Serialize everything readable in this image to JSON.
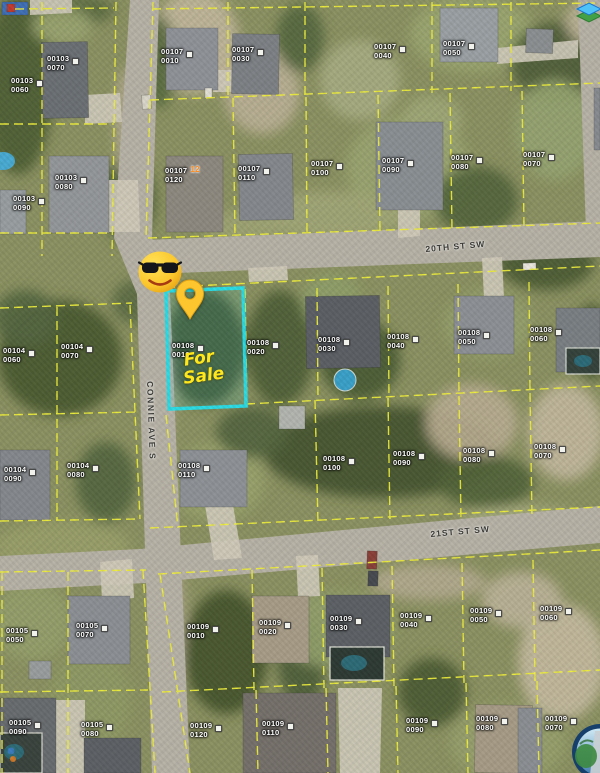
{
  "map": {
    "streets": [
      {
        "name": "20TH ST SW",
        "orientation": "horizontal"
      },
      {
        "name": "21ST ST SW",
        "orientation": "horizontal"
      },
      {
        "name": "CONNIE AVE S",
        "orientation": "vertical"
      }
    ],
    "listing": {
      "line1": "For",
      "line2": "Sale",
      "parcel": "00108 0010",
      "highlight_color": "#2bdce5",
      "text_color": "#ffe71c"
    },
    "icons": {
      "marker": "location-pin-icon",
      "emoji": "sunglasses-face-emoji",
      "top_right": "map-layers-icon",
      "bottom_right": "globe-aerial-logo"
    },
    "colors": {
      "parcel_line": "#eded3c",
      "label_text": "#ffffff",
      "street_text": "#3b3b37",
      "pin": "#fdc62f",
      "road": "#b7b2a6"
    },
    "parcel_labels": [
      {
        "b": "00103",
        "l": "0070",
        "x": 47,
        "y": 55
      },
      {
        "b": "00103",
        "l": "0060",
        "x": 11,
        "y": 77
      },
      {
        "b": "00103",
        "l": "0080",
        "x": 55,
        "y": 174
      },
      {
        "b": "00103",
        "l": "0090",
        "x": 13,
        "y": 195
      },
      {
        "b": "00107",
        "l": "0010",
        "x": 161,
        "y": 48
      },
      {
        "b": "00107",
        "l": "0030",
        "x": 232,
        "y": 46
      },
      {
        "b": "00107",
        "l": "0040",
        "x": 374,
        "y": 43
      },
      {
        "b": "00107",
        "l": "0050",
        "x": 443,
        "y": 40
      },
      {
        "b": "00107",
        "l": "0120",
        "x": 165,
        "y": 167,
        "m": "12"
      },
      {
        "b": "00107",
        "l": "0110",
        "x": 238,
        "y": 165
      },
      {
        "b": "00107",
        "l": "0100",
        "x": 311,
        "y": 160
      },
      {
        "b": "00107",
        "l": "0090",
        "x": 382,
        "y": 157
      },
      {
        "b": "00107",
        "l": "0080",
        "x": 451,
        "y": 154
      },
      {
        "b": "00107",
        "l": "0070",
        "x": 523,
        "y": 151
      },
      {
        "b": "00104",
        "l": "0060",
        "x": 3,
        "y": 347
      },
      {
        "b": "00104",
        "l": "0070",
        "x": 61,
        "y": 343
      },
      {
        "b": "00104",
        "l": "0090",
        "x": 4,
        "y": 466
      },
      {
        "b": "00104",
        "l": "0080",
        "x": 67,
        "y": 462
      },
      {
        "b": "00108",
        "l": "0010",
        "x": 172,
        "y": 342
      },
      {
        "b": "00108",
        "l": "0020",
        "x": 247,
        "y": 339
      },
      {
        "b": "00108",
        "l": "0030",
        "x": 318,
        "y": 336
      },
      {
        "b": "00108",
        "l": "0040",
        "x": 387,
        "y": 333
      },
      {
        "b": "00108",
        "l": "0050",
        "x": 458,
        "y": 329
      },
      {
        "b": "00108",
        "l": "0060",
        "x": 530,
        "y": 326
      },
      {
        "b": "00108",
        "l": "0110",
        "x": 178,
        "y": 462
      },
      {
        "b": "00108",
        "l": "0100",
        "x": 323,
        "y": 455
      },
      {
        "b": "00108",
        "l": "0090",
        "x": 393,
        "y": 450
      },
      {
        "b": "00108",
        "l": "0080",
        "x": 463,
        "y": 447
      },
      {
        "b": "00108",
        "l": "0070",
        "x": 534,
        "y": 443
      },
      {
        "b": "00105",
        "l": "0050",
        "x": 6,
        "y": 627
      },
      {
        "b": "00105",
        "l": "0070",
        "x": 76,
        "y": 622
      },
      {
        "b": "00105",
        "l": "0090",
        "x": 9,
        "y": 719
      },
      {
        "b": "00105",
        "l": "0080",
        "x": 81,
        "y": 721
      },
      {
        "b": "00109",
        "l": "0010",
        "x": 187,
        "y": 623
      },
      {
        "b": "00109",
        "l": "0020",
        "x": 259,
        "y": 619
      },
      {
        "b": "00109",
        "l": "0030",
        "x": 330,
        "y": 615
      },
      {
        "b": "00109",
        "l": "0040",
        "x": 400,
        "y": 612
      },
      {
        "b": "00109",
        "l": "0050",
        "x": 470,
        "y": 607
      },
      {
        "b": "00109",
        "l": "0060",
        "x": 540,
        "y": 605
      },
      {
        "b": "00109",
        "l": "0120",
        "x": 190,
        "y": 722
      },
      {
        "b": "00109",
        "l": "0110",
        "x": 262,
        "y": 720
      },
      {
        "b": "00109",
        "l": "0090",
        "x": 406,
        "y": 717
      },
      {
        "b": "00109",
        "l": "0080",
        "x": 476,
        "y": 715
      },
      {
        "b": "00109",
        "l": "0070",
        "x": 545,
        "y": 715
      }
    ]
  },
  "features": {
    "road_color": "#b7b2a6",
    "driveway_color": "#cfcaba",
    "roads": [
      "130,0 159,0 152,238 170,294 190,773 152,773 137,294 114,238",
      "146,240 600,221 600,257 150,274",
      "0,556 140,549 600,506 600,543 144,583 0,591",
      "578,0 600,0 600,236 586,232"
    ],
    "driveways": [
      "85,95 120,93 122,122 85,124",
      "104,180 138,180 140,232 106,232",
      "205,505 233,505 242,558 214,560",
      "100,562 132,559 134,598 102,600",
      "398,210 420,210 420,236 398,238",
      "296,556 318,555 320,596 298,597",
      "338,688 382,688 380,773 340,773",
      "482,258 502,257 504,298 484,298",
      "497,48 578,40 578,58 497,64",
      "30,0 72,0 72,13 30,15",
      "213,70 240,70 240,92 213,92",
      "248,268 287,266 288,280 249,282",
      "55,700 85,700 85,773 55,773"
    ],
    "structures": [
      [
        42,
        42,
        46,
        76,
        -1,
        "#6b7074"
      ],
      [
        166,
        28,
        52,
        62,
        0,
        "#8f9398"
      ],
      [
        232,
        34,
        47,
        60,
        1,
        "#7d8185"
      ],
      [
        440,
        8,
        58,
        54,
        0,
        "#9aa0a3"
      ],
      [
        526,
        29,
        27,
        24,
        2,
        "#8b8f91"
      ],
      [
        49,
        156,
        60,
        77,
        0,
        "#94979a"
      ],
      [
        166,
        156,
        57,
        76,
        0,
        "#8e897f"
      ],
      [
        239,
        154,
        54,
        66,
        -1,
        "#85898d"
      ],
      [
        376,
        122,
        67,
        88,
        0,
        "#8a8f93"
      ],
      [
        594,
        88,
        6,
        62,
        0,
        "#888c90"
      ],
      [
        0,
        190,
        26,
        44,
        0,
        "#989ea0"
      ],
      [
        306,
        296,
        74,
        72,
        -1,
        "#5c6065"
      ],
      [
        454,
        296,
        60,
        58,
        0,
        "#8d9195"
      ],
      [
        556,
        308,
        44,
        64,
        0,
        "#7a7f83"
      ],
      [
        180,
        450,
        67,
        57,
        0,
        "#8e9296"
      ],
      [
        0,
        450,
        50,
        70,
        0,
        "#85898d"
      ],
      [
        279,
        406,
        26,
        23,
        0,
        "#b2b5af"
      ],
      [
        68,
        596,
        62,
        68,
        0,
        "#8c9094"
      ],
      [
        29,
        661,
        22,
        18,
        0,
        "#999d9d"
      ],
      [
        252,
        596,
        57,
        67,
        0,
        "#a79c87"
      ],
      [
        326,
        595,
        64,
        62,
        0,
        "#5d6165"
      ],
      [
        0,
        698,
        56,
        75,
        0,
        "#686c6f"
      ],
      [
        84,
        738,
        57,
        35,
        0,
        "#5d6165"
      ],
      [
        243,
        693,
        93,
        80,
        0,
        "#75706a"
      ],
      [
        475,
        705,
        57,
        68,
        1,
        "#a69b86"
      ],
      [
        518,
        708,
        24,
        65,
        0,
        "#8b8f93"
      ],
      [
        142,
        95,
        9,
        14,
        -4,
        "#d9d6c9"
      ],
      [
        523,
        263,
        13,
        7,
        -2,
        "#e9e7dd"
      ],
      [
        367,
        551,
        10,
        18,
        2,
        "#8a4038"
      ],
      [
        368,
        571,
        10,
        15,
        2,
        "#474a50"
      ],
      [
        2,
        2,
        26,
        13,
        0,
        "#3f6fb5"
      ],
      [
        7,
        4,
        8,
        8,
        0,
        "#c23b2e"
      ],
      [
        205,
        88,
        7,
        10,
        0,
        "#e2dfd4"
      ]
    ],
    "pools": [
      {
        "t": "c",
        "cx": 345,
        "cy": 380,
        "r": 11,
        "f": "#3aa0c8",
        "s": "#d3d8d0"
      },
      {
        "t": "e",
        "cx": 3,
        "cy": 161,
        "rx": 12,
        "ry": 9,
        "f": "#49aad2"
      },
      {
        "t": "r",
        "x": 566,
        "y": 348,
        "w": 34,
        "h": 26,
        "f": "#35423c",
        "s": "#d8dcd2"
      },
      {
        "t": "e",
        "cx": 583,
        "cy": 361,
        "rx": 9,
        "ry": 6,
        "f": "#2c6b78"
      },
      {
        "t": "r",
        "x": 330,
        "y": 647,
        "w": 54,
        "h": 33,
        "f": "#2e3a34",
        "s": "#e4e6da"
      },
      {
        "t": "e",
        "cx": 354,
        "cy": 663,
        "rx": 13,
        "ry": 8,
        "f": "#2d6b76"
      },
      {
        "t": "r",
        "x": 0,
        "y": 733,
        "w": 42,
        "h": 40,
        "f": "#3a433d",
        "s": "#dadcd2"
      },
      {
        "t": "e",
        "cx": 14,
        "cy": 752,
        "rx": 10,
        "ry": 8,
        "f": "#2d6b76"
      },
      {
        "t": "c",
        "cx": 11,
        "cy": 751,
        "r": 3.5,
        "f": "#3a7abc"
      },
      {
        "t": "c",
        "cx": 13,
        "cy": 759,
        "r": 3,
        "f": "#d07a28"
      }
    ],
    "patches": [
      [
        18,
        85,
        35,
        90,
        "#4e5e35"
      ],
      [
        70,
        10,
        45,
        16,
        "#5d6d43"
      ],
      [
        195,
        42,
        44,
        52,
        "#c1b79c"
      ],
      [
        262,
        92,
        38,
        42,
        "#bbb196"
      ],
      [
        300,
        38,
        24,
        34,
        "#57693f"
      ],
      [
        472,
        34,
        62,
        38,
        "#9ba671"
      ],
      [
        556,
        62,
        46,
        40,
        "#50603a"
      ],
      [
        588,
        22,
        22,
        22,
        "#bfb59a"
      ],
      [
        128,
        200,
        28,
        42,
        "#52643a"
      ],
      [
        408,
        168,
        62,
        52,
        "#9aa571"
      ],
      [
        476,
        200,
        42,
        34,
        "#54663c"
      ],
      [
        330,
        215,
        82,
        24,
        "#a2a777"
      ],
      [
        60,
        358,
        62,
        58,
        "#4a5a32"
      ],
      [
        25,
        318,
        32,
        28,
        "#556741"
      ],
      [
        205,
        348,
        40,
        58,
        "#45552f"
      ],
      [
        280,
        348,
        34,
        58,
        "#4f6038"
      ],
      [
        382,
        452,
        118,
        46,
        "#45552f"
      ],
      [
        332,
        302,
        30,
        28,
        "#8fa06a"
      ],
      [
        488,
        324,
        44,
        34,
        "#96a16d"
      ],
      [
        472,
        422,
        46,
        38,
        "#b8ad91"
      ],
      [
        566,
        432,
        38,
        48,
        "#c2b89d"
      ],
      [
        546,
        262,
        48,
        28,
        "#4c5c34"
      ],
      [
        216,
        482,
        48,
        38,
        "#99a36e"
      ],
      [
        106,
        482,
        30,
        40,
        "#556740"
      ],
      [
        62,
        546,
        68,
        24,
        "#99a06a"
      ],
      [
        226,
        652,
        42,
        62,
        "#45552d"
      ],
      [
        302,
        662,
        24,
        44,
        "#4f5f39"
      ],
      [
        336,
        630,
        58,
        38,
        "#93a06b"
      ],
      [
        562,
        662,
        44,
        58,
        "#c4bba0"
      ],
      [
        522,
        600,
        40,
        28,
        "#bcb399"
      ],
      [
        508,
        742,
        58,
        38,
        "#97a16c"
      ],
      [
        432,
        692,
        34,
        34,
        "#4c5c34"
      ],
      [
        32,
        622,
        40,
        38,
        "#95a06b"
      ],
      [
        428,
        582,
        58,
        18,
        "#b3aa8f"
      ],
      [
        160,
        62,
        16,
        46,
        "#596b41"
      ],
      [
        62,
        26,
        30,
        18,
        "#9aa571"
      ],
      [
        592,
        342,
        18,
        38,
        "#4a5a32"
      ],
      [
        136,
        302,
        24,
        22,
        "#5d6e44"
      ],
      [
        486,
        482,
        48,
        26,
        "#53643b"
      ],
      [
        244,
        228,
        40,
        18,
        "#9ea474"
      ],
      [
        125,
        122,
        10,
        55,
        "#b3aa90"
      ],
      [
        162,
        402,
        10,
        70,
        "#b2a98f"
      ],
      [
        174,
        622,
        10,
        70,
        "#b2a98f"
      ],
      [
        520,
        520,
        60,
        14,
        "#a8ad80"
      ],
      [
        90,
        700,
        40,
        50,
        "#8f9a66"
      ],
      [
        360,
        360,
        40,
        40,
        "#4b5b33"
      ],
      [
        252,
        432,
        36,
        26,
        "#556640"
      ],
      [
        555,
        130,
        40,
        50,
        "#96a471"
      ],
      [
        360,
        80,
        40,
        40,
        "#a8ad82"
      ],
      [
        432,
        120,
        30,
        25,
        "#9fa878"
      ]
    ],
    "parcel_lines_d": "M42,2 L42,256 M0,124 L114,124 M116,2 L112,256 M0,233 L113,233 M15,9 L114,8 M152,9 L600,3 M153,2 L146,238 M228,2 L228,97 M305,2 L305,96 M432,2 L432,93 M511,2 L511,91 M150,100 L600,83 M233,98 L235,236 M306,97 L307,234 M378,95 L380,232 M450,93 L452,230 M522,91 L524,228 M148,238 L600,223 M0,308 L132,303 M57,307 L57,520 M0,415 L136,412 M0,521 L140,519 M130,305 L140,519 M152,288 L600,266 M246,404 L600,386 M150,528 L600,507 M166,415 L178,528 M245,289 L247,404 M317,288 L318,400 M388,286 L389,398 M458,284 L459,396 M529,282 L530,393 M315,400 L318,524 M388,398 L390,522 M459,396 L461,520 M530,393 L532,518 M2,572 L2,773 M0,572 L146,570 M68,572 L68,773 M0,692 L148,690 M143,570 L155,773 M158,574 L600,550 M162,692 L600,670 M160,574 L190,773 M252,570 L254,690 M322,568 L324,688 M392,566 L394,686 M462,563 L464,683 M533,560 L535,681 M256,690 L258,773 M326,688 L328,773 M396,686 L398,773 M466,683 L468,773 M537,681 L539,773",
    "cyan_parcel_points": "166,291 243,288 246,406 169,409"
  }
}
